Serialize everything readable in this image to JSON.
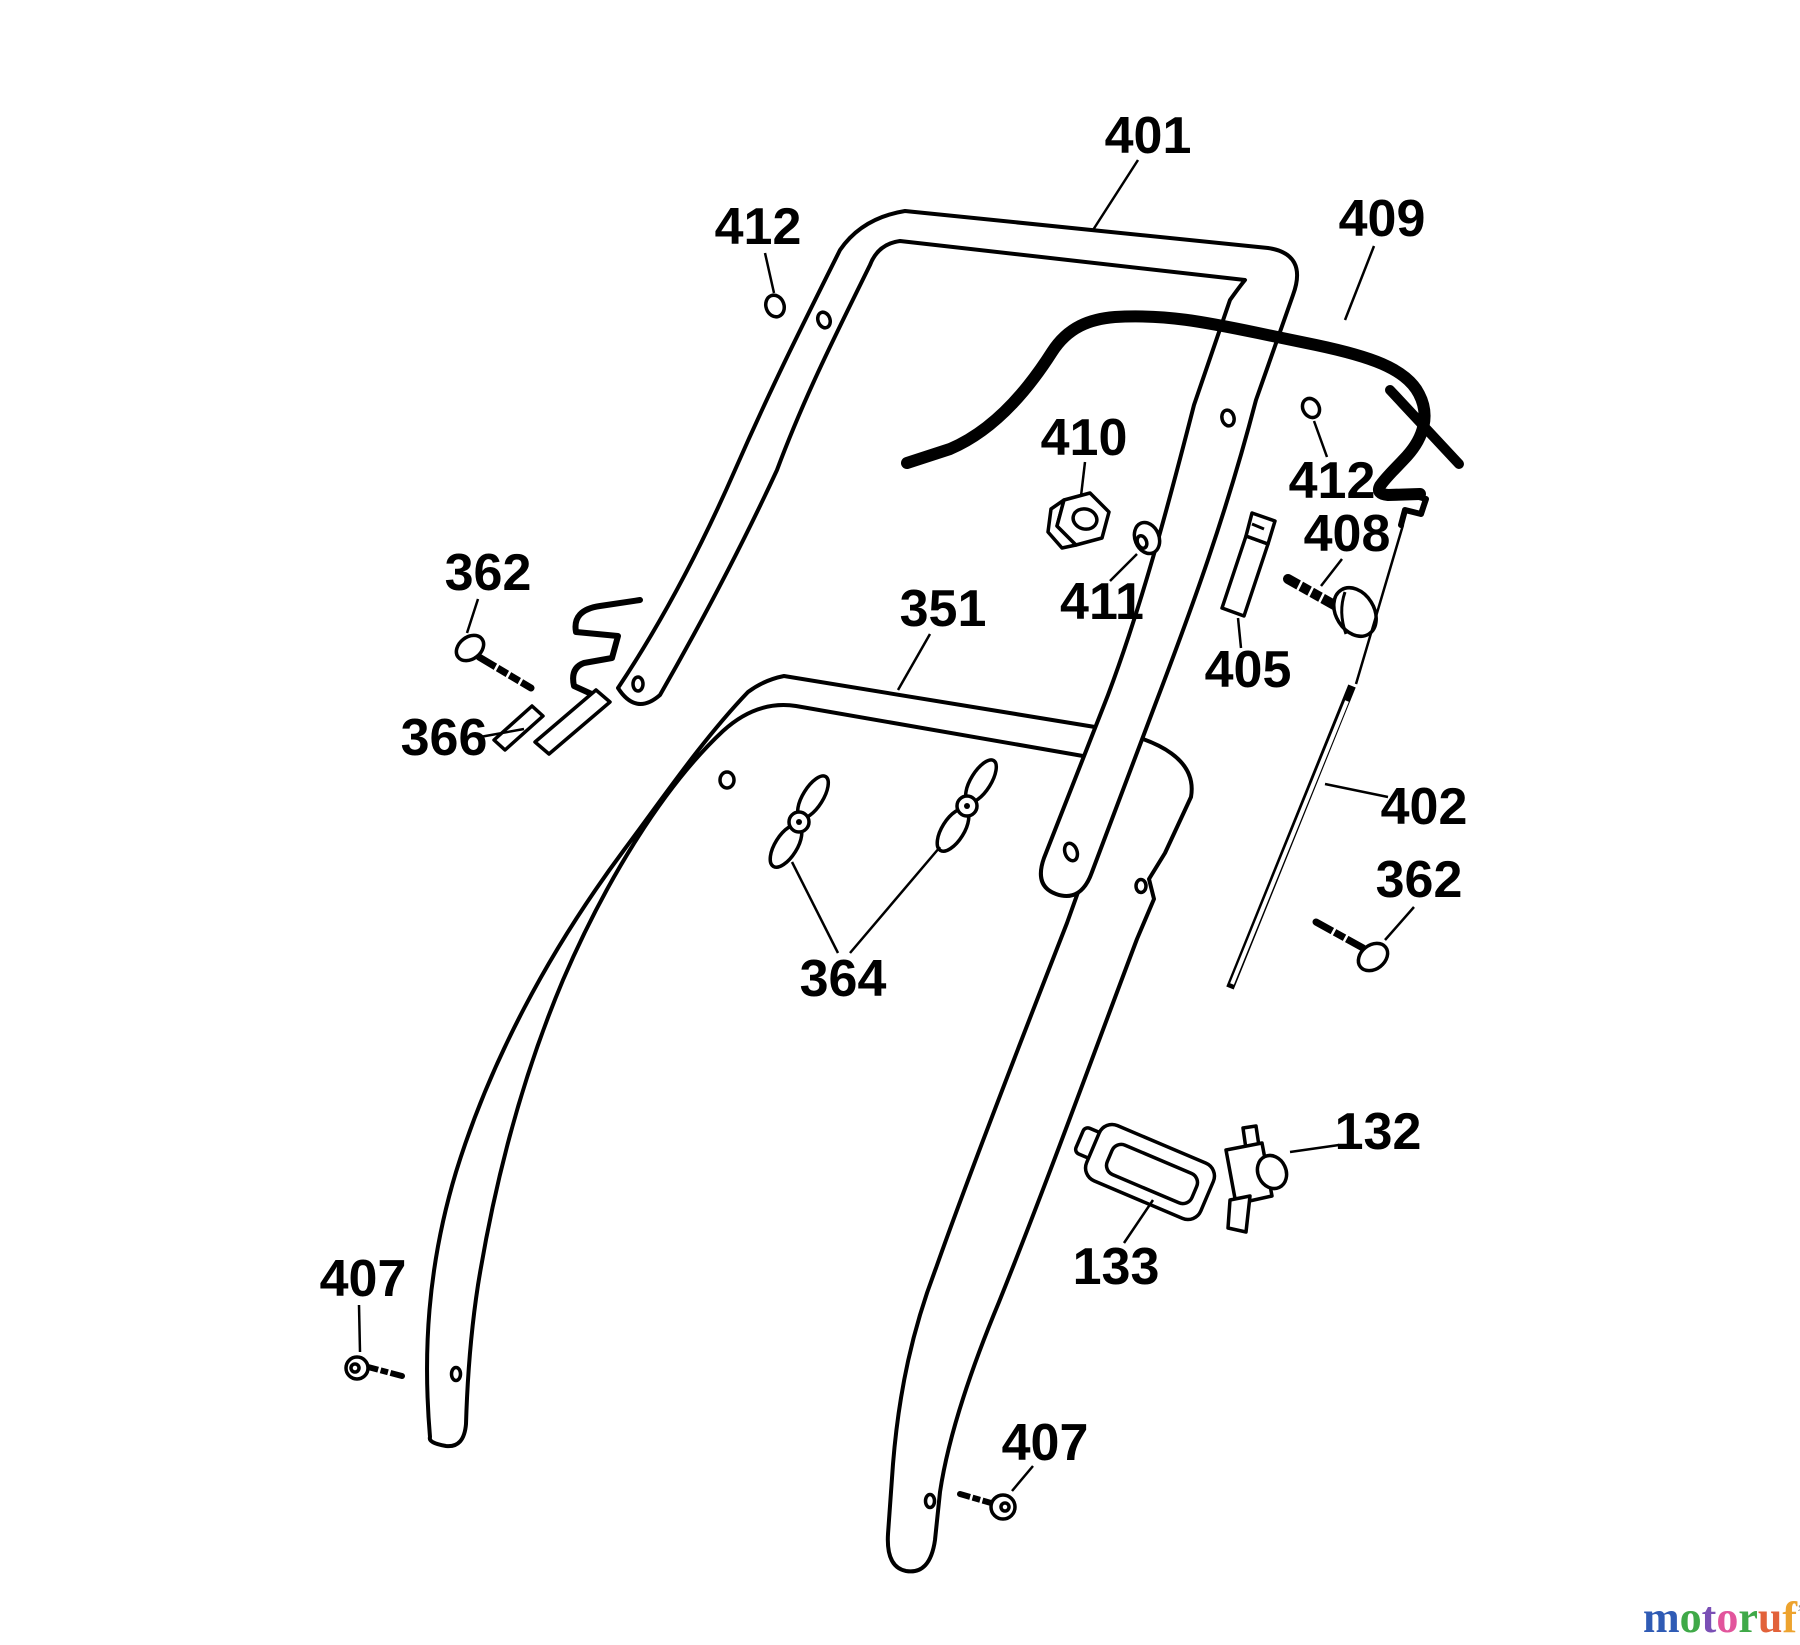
{
  "diagram": {
    "type": "exploded-parts-diagram",
    "subject": "lawn mower handle assembly",
    "parts": [
      {
        "number": "401",
        "name": "upper-handle-bar"
      },
      {
        "number": "412",
        "name": "plug-upper-left"
      },
      {
        "number": "409",
        "name": "control-cable"
      },
      {
        "number": "410",
        "name": "flange-nut"
      },
      {
        "number": "411",
        "name": "curved-washer"
      },
      {
        "number": "412",
        "name": "plug-upper-right"
      },
      {
        "number": "408",
        "name": "handle-bolt"
      },
      {
        "number": "405",
        "name": "cable-clip"
      },
      {
        "number": "402",
        "name": "brake-rod"
      },
      {
        "number": "351",
        "name": "lower-handle-bar"
      },
      {
        "number": "362",
        "name": "screw-left"
      },
      {
        "number": "366",
        "name": "cable-guide-clip"
      },
      {
        "number": "362",
        "name": "screw-right"
      },
      {
        "number": "364",
        "name": "wing-nuts"
      },
      {
        "number": "132",
        "name": "switch-connector"
      },
      {
        "number": "133",
        "name": "switch-gasket"
      },
      {
        "number": "407",
        "name": "screw-lower-left"
      },
      {
        "number": "407",
        "name": "screw-lower-right"
      }
    ]
  },
  "watermark": {
    "text": "motoruf.de",
    "letters": [
      {
        "ch": "m",
        "color": "#2f5bb5"
      },
      {
        "ch": "o",
        "color": "#3fa948"
      },
      {
        "ch": "t",
        "color": "#7a4fb5"
      },
      {
        "ch": "o",
        "color": "#e2559c"
      },
      {
        "ch": "r",
        "color": "#3fa948"
      },
      {
        "ch": "u",
        "color": "#e2623a"
      },
      {
        "ch": "f",
        "color": "#eda32e"
      }
    ],
    "mark": {
      "ch": "’",
      "color": "#999999"
    },
    "suffix": {
      "text": ".de",
      "color": "#8c8c8c"
    }
  }
}
